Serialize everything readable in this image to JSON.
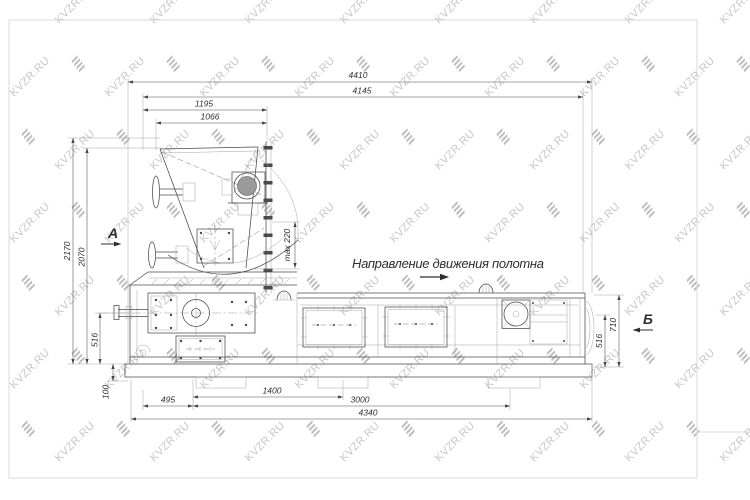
{
  "watermark": {
    "text": "KVZR.RU"
  },
  "drawing": {
    "direction_label": "Направление движения полотна",
    "view_a": "А",
    "view_b": "Б",
    "dims": {
      "top_4410": "4410",
      "top_4145": "4145",
      "top_1195": "1195",
      "top_1066": "1066",
      "left_2170": "2170",
      "left_2070": "2070",
      "left_516": "516",
      "left_100": "100",
      "bottom_495": "495",
      "bottom_1400": "1400",
      "bottom_3000": "3000",
      "bottom_4340": "4340",
      "right_516": "516",
      "right_710": "710",
      "max_220": "max 220"
    }
  }
}
